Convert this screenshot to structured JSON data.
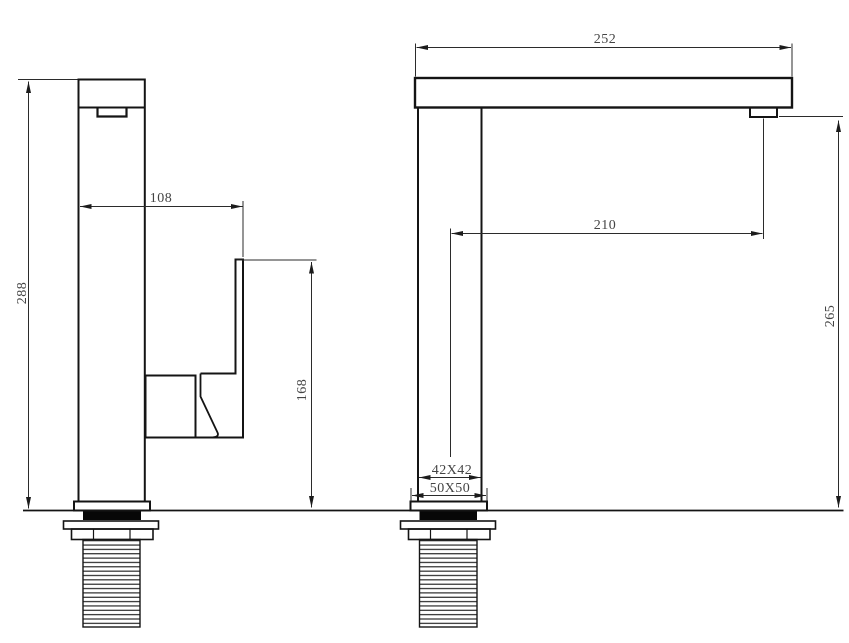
{
  "drawing": {
    "dimensions": {
      "spout_overall_length": "252",
      "spout_reach": "210",
      "spout_outlet_height": "265",
      "overall_height": "288",
      "handle_reach": "108",
      "handle_top_height": "168",
      "body_cross_section": "42X42",
      "base_plate_size": "50X50"
    }
  }
}
